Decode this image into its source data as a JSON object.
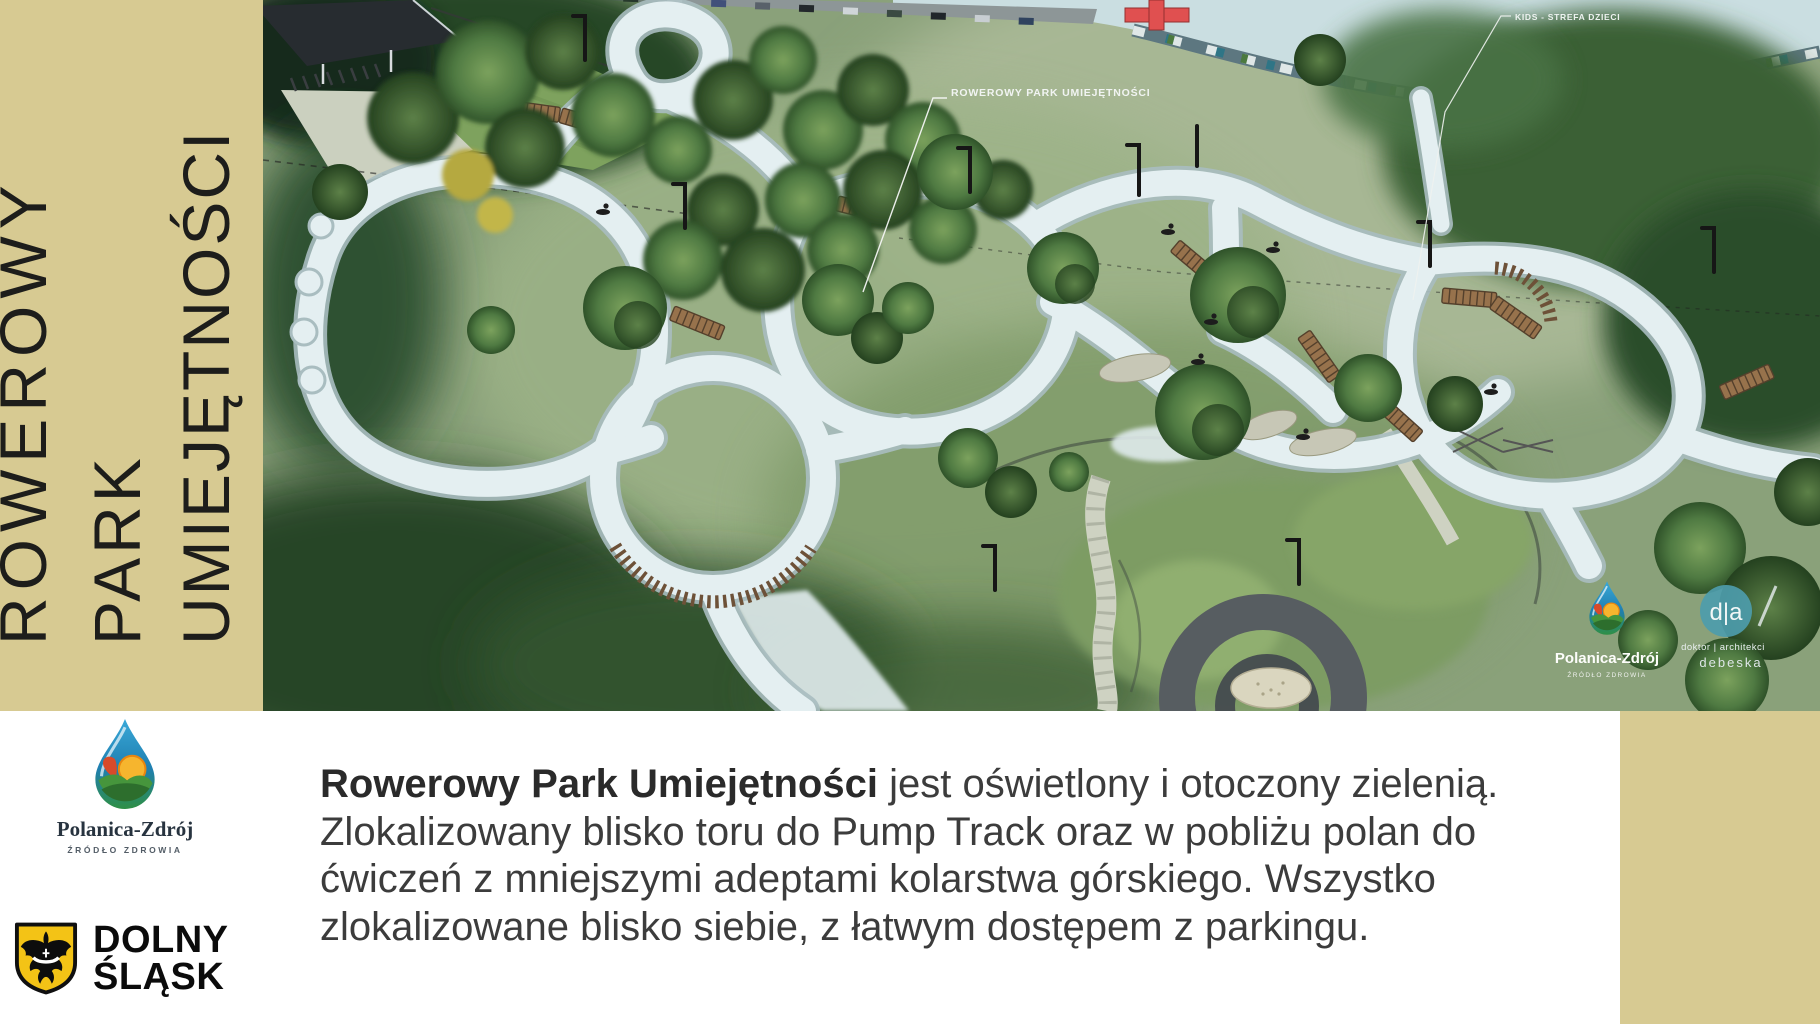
{
  "sidebar": {
    "title": [
      "ROWEROWY",
      "PARK",
      "UMIEJĘTNOŚCI"
    ]
  },
  "image": {
    "labels": {
      "park_label": "ROWEROWY PARK UMIEJĘTNOŚCI",
      "kids_label": "KIDS - STREFA DZIECI"
    },
    "watermark_polanica": {
      "name": "Polanica-Zdrój",
      "tagline": "ŹRÓDŁO ZDROWIA"
    },
    "watermark_studio": {
      "monogram": "d|a",
      "line1": "doktor | architekci",
      "line2": "debeska"
    }
  },
  "footer": {
    "polanica": {
      "name": "Polanica-Zdrój",
      "tagline": "ŹRÓDŁO ZDROWIA"
    },
    "dolny_slask": {
      "line1": "DOLNY",
      "line2": "ŚLĄSK"
    },
    "paragraph": {
      "lines": [
        {
          "lead": "Rowerowy Park Umiejętności",
          "text": " jest oświetlony i otoczony zielenią."
        },
        {
          "text": "Zlokalizowany blisko toru do Pump Track oraz w pobliżu polan do"
        },
        {
          "text": "ćwiczeń z mniejszymi adeptami kolarstwa górskiego. Wszystko"
        },
        {
          "text": "zlokalizowane blisko siebie, z łatwym dostępem z parkingu."
        }
      ]
    }
  },
  "colors": {
    "sidebar_tan": "#d7ca92",
    "title_text": "#1d1d1b",
    "paragraph_text": "#3c3c3c",
    "track_surface": "#e4eff1",
    "grass_base": "#8aa17a",
    "water_sky": "#cadee1",
    "studio_circle_teal": "#4d9cab",
    "red_structure": "#e05050",
    "shield_yellow": "#f3c316"
  }
}
